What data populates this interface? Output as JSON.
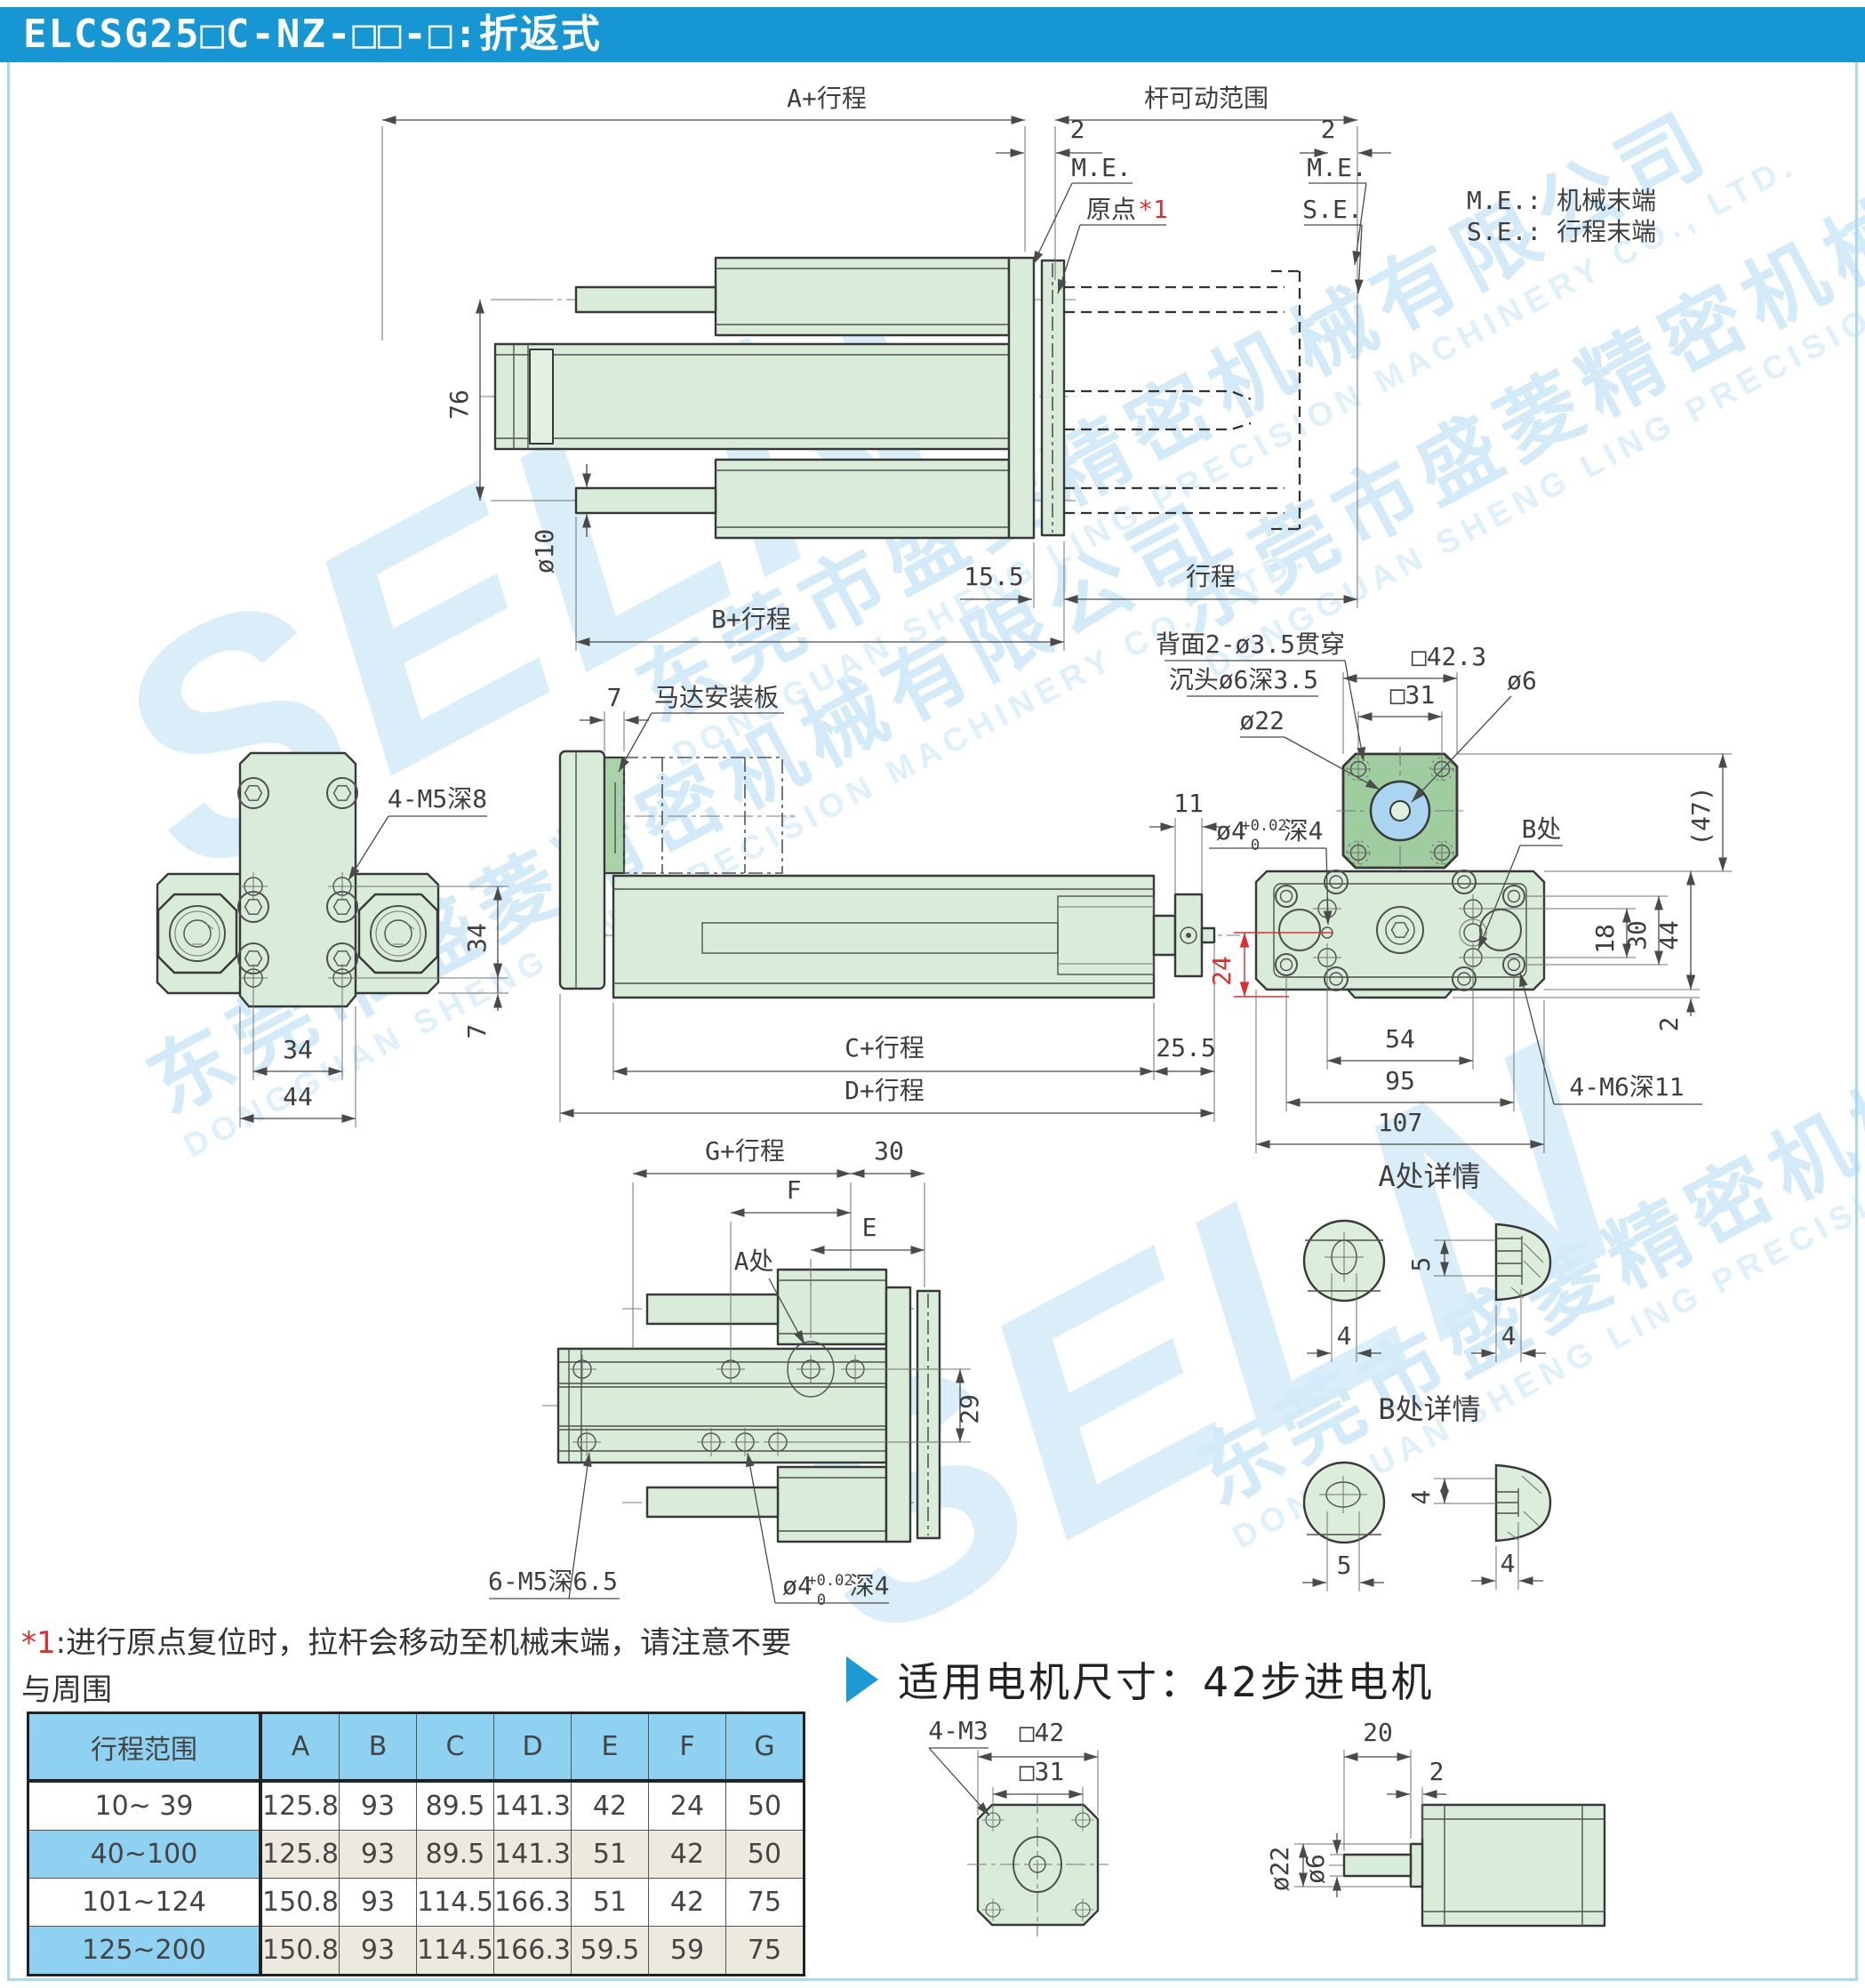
{
  "page": {
    "title": "ELCSG25□C-NZ-□□-□:折返式"
  },
  "colors": {
    "accent_blue": "#1697d4",
    "body_green": "#d9ecd9",
    "flange_green": "#9fcd9f",
    "hole_blue": "#aad4f0",
    "table_blue": "#8fd1f1",
    "table_beige": "#ece9df",
    "annotation_red": "#d93030",
    "watermark_blue": "#d3ebf8"
  },
  "watermark": {
    "brand": "SELN",
    "company_cn": "东莞市盛菱精密机械有限公司",
    "company_en": "DONGGUAN SHENG LING PRECISION MACHINERY CO., LTD."
  },
  "legend": {
    "me": "M.E.: 机械末端",
    "se": "S.E.: 行程末端"
  },
  "top_view": {
    "dim_a": "A+行程",
    "dim_rod_range": "杆可动范围",
    "dim_2l": "2",
    "dim_2r": "2",
    "me_l": "M.E.",
    "origin": "原点",
    "origin_ref": "*1",
    "me_r": "M.E.",
    "se": "S.E.",
    "dim_76": "76",
    "dim_d10": "ø10",
    "dim_15_5": "15.5",
    "dim_stroke": "行程",
    "dim_b": "B+行程"
  },
  "front_view": {
    "thread": "4-M5深8",
    "dim_34v": "34",
    "dim_7": "7",
    "dim_34": "34",
    "dim_44": "44"
  },
  "side_view": {
    "dim_7": "7",
    "motor_plate": "马达安装板",
    "dim_11": "11",
    "dim_c": "C+行程",
    "dim_25_5": "25.5",
    "dim_d": "D+行程"
  },
  "rear_view": {
    "note1": "背面2-ø3.5贯穿",
    "note2": "沉头ø6深3.5",
    "dim_d22": "ø22",
    "dim_sq423": "□42.3",
    "dim_sq31": "□31",
    "dim_d6": "ø6",
    "dim_d4": "ø4",
    "tol_sup": "+0.02",
    "tol_sub": "0",
    "d4_depth": "深4",
    "label_b": "B处",
    "dim_24": "24",
    "dim_18": "18",
    "dim_30": "30",
    "dim_44": "44",
    "dim_2": "2",
    "dim_47": "(47)",
    "dim_54": "54",
    "dim_95": "95",
    "dim_107": "107",
    "thread": "4-M6深11"
  },
  "plan_view": {
    "dim_g": "G+行程",
    "dim_30": "30",
    "dim_f": "F",
    "dim_e": "E",
    "label_a": "A处",
    "dim_29": "29",
    "thread": "6-M5深6.5",
    "dim_d4": "ø4",
    "tol_sup": "+0.02",
    "tol_sub": "0",
    "d4_depth": "深4"
  },
  "detail_a": {
    "title": "A处详情",
    "dim_5": "5",
    "dim_4a": "4",
    "dim_4b": "4"
  },
  "detail_b": {
    "title": "B处详情",
    "dim_4a": "4",
    "dim_5": "5",
    "dim_4b": "4"
  },
  "footnote": {
    "ref": "*1",
    "line1": ":进行原点复位时，拉杆会移动至机械末端，请注意不要与周围",
    "line2": "工件、设备产生干涉。"
  },
  "table": {
    "headers": [
      "行程范围",
      "A",
      "B",
      "C",
      "D",
      "E",
      "F",
      "G"
    ],
    "rows": [
      {
        "range": "10~ 39",
        "a": "125.8",
        "b": "93",
        "c": "89.5",
        "d": "141.3",
        "e": "42",
        "f": "24",
        "g": "50"
      },
      {
        "range": "40~100",
        "a": "125.8",
        "b": "93",
        "c": "89.5",
        "d": "141.3",
        "e": "51",
        "f": "42",
        "g": "50"
      },
      {
        "range": "101~124",
        "a": "150.8",
        "b": "93",
        "c": "114.5",
        "d": "166.3",
        "e": "51",
        "f": "42",
        "g": "75"
      },
      {
        "range": "125~200",
        "a": "150.8",
        "b": "93",
        "c": "114.5",
        "d": "166.3",
        "e": "59.5",
        "f": "59",
        "g": "75"
      }
    ]
  },
  "motor": {
    "title": "适用电机尺寸：42步进电机",
    "thread": "4-M3",
    "dim_sq42": "□42",
    "dim_sq31": "□31",
    "dim_d22": "ø22",
    "dim_d6": "ø6",
    "dim_20": "20",
    "dim_2": "2"
  }
}
